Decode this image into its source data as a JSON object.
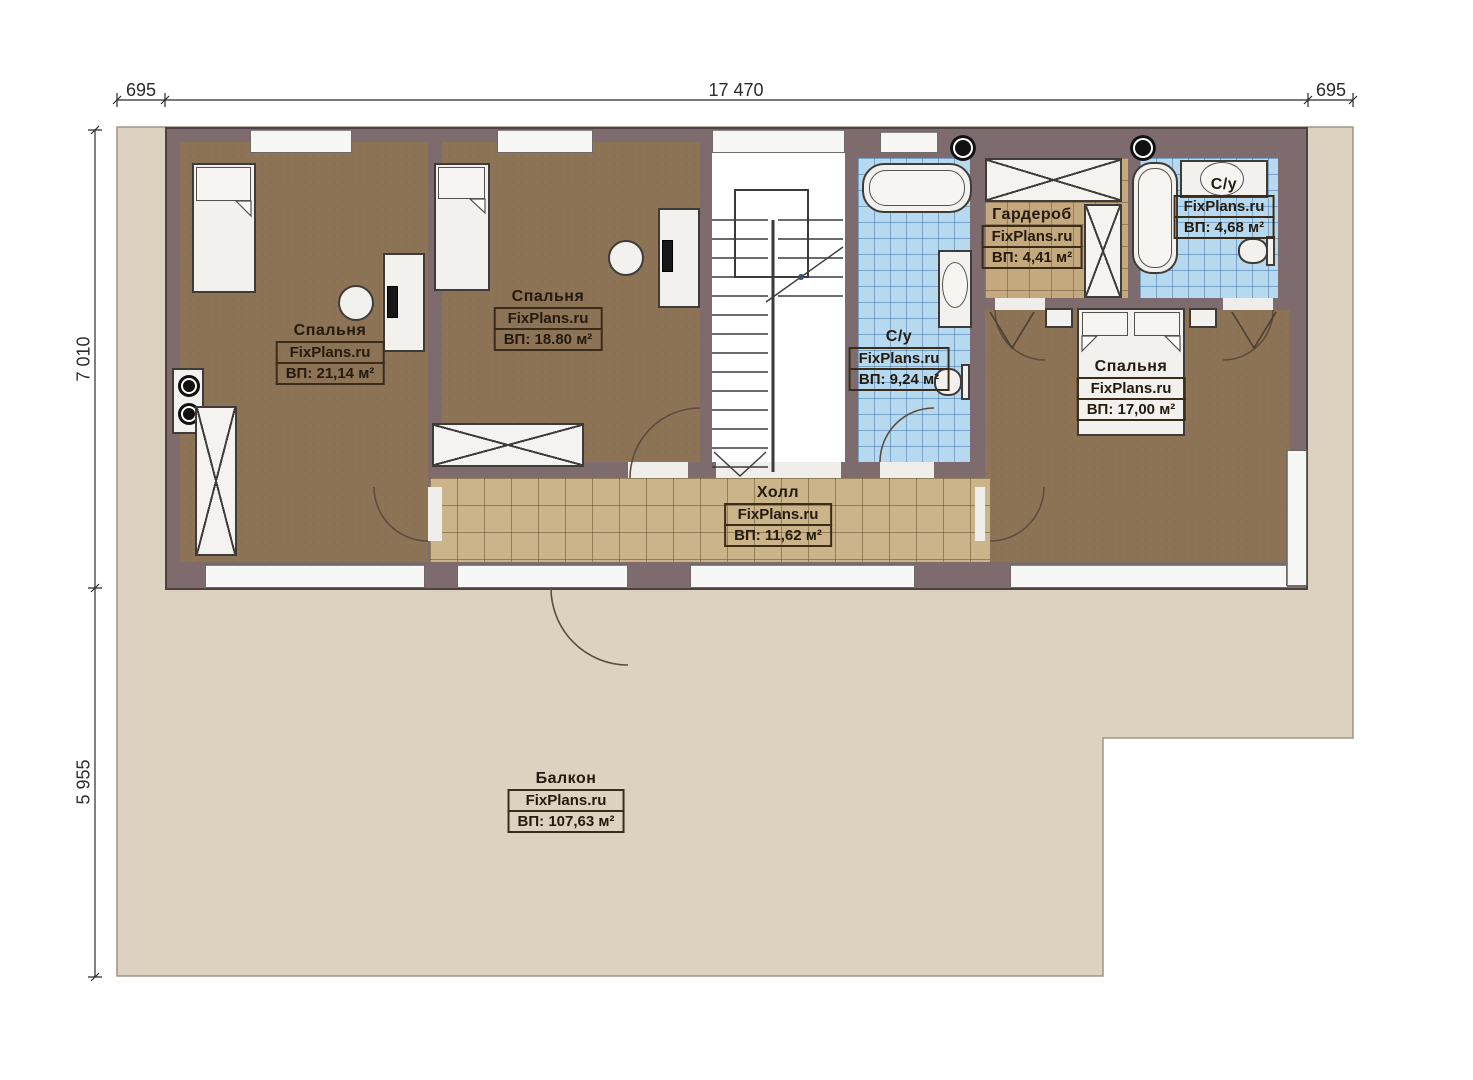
{
  "brand": "FixPlans.ru",
  "dimensions": {
    "top_left": "695",
    "top_width": "17 470",
    "top_right": "695",
    "left_height": "7 010",
    "left_balcony": "5 955"
  },
  "rooms": {
    "bedroom1": {
      "name": "Спальня",
      "brand": "FixPlans.ru",
      "area": "ВП: 21,14 м²"
    },
    "bedroom2": {
      "name": "Спальня",
      "brand": "FixPlans.ru",
      "area": "ВП: 18.80 м²"
    },
    "wc1": {
      "name": "С/у",
      "brand": "FixPlans.ru",
      "area": "ВП: 9,24 м²"
    },
    "wardrobe": {
      "name": "Гардероб",
      "brand": "FixPlans.ru",
      "area": "ВП: 4,41 м²"
    },
    "wc2": {
      "name": "С/у",
      "brand": "FixPlans.ru",
      "area": "ВП: 4,68 м²"
    },
    "bedroom3": {
      "name": "Спальня",
      "brand": "FixPlans.ru",
      "area": "ВП: 17,00 м²"
    },
    "hall": {
      "name": "Холл",
      "brand": "FixPlans.ru",
      "area": "ВП: 11,62 м²"
    },
    "balcony": {
      "name": "Балкон",
      "brand": "FixPlans.ru",
      "area": "ВП: 107,63 м²"
    }
  },
  "colors": {
    "wall": "#7d6b6d",
    "bedroom_floor": "#8c7355",
    "tile_floor": "#cbb489",
    "wet_floor": "#b7d9ef",
    "terrace": "#ddd2c0"
  }
}
